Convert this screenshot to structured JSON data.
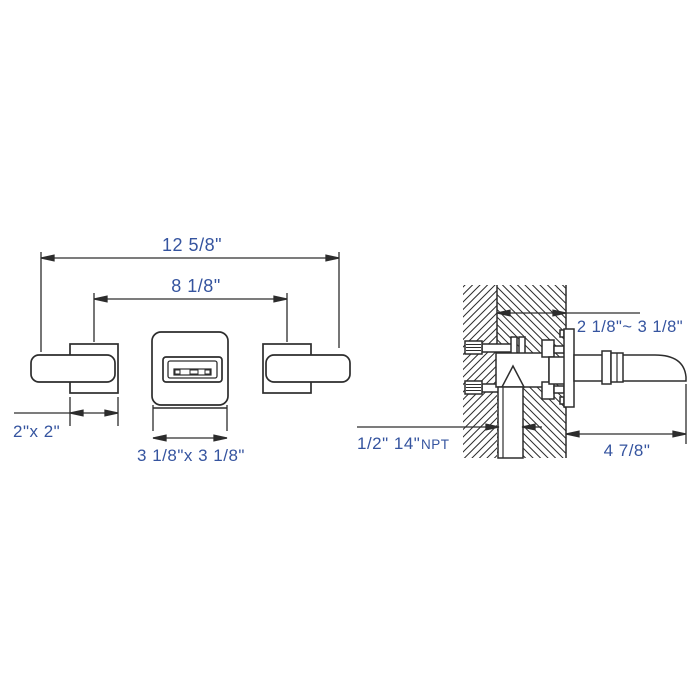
{
  "drawing": {
    "type": "technical-installation-diagram",
    "subject": "wall-mounted two-handle faucet dimension drawing",
    "colors": {
      "line": "#2d2d2d",
      "dimension_text": "#35549f",
      "background": "#ffffff",
      "fill_white": "#ffffff"
    },
    "front_view": {
      "name": "front elevation view",
      "overall_width": "12 5/8\"",
      "handle_spacing": "8 1/8\"",
      "handle_size": "2\"x 2\"",
      "plate_size": "3 1/8\"x 3 1/8\""
    },
    "side_view": {
      "name": "wall section side view",
      "wall_thickness": "2 1/8\"~ 3 1/8\"",
      "inlet_thread": "1/2\" 14\"",
      "inlet_thread_suffix": "NPT",
      "spout_reach": "4 7/8\""
    }
  }
}
